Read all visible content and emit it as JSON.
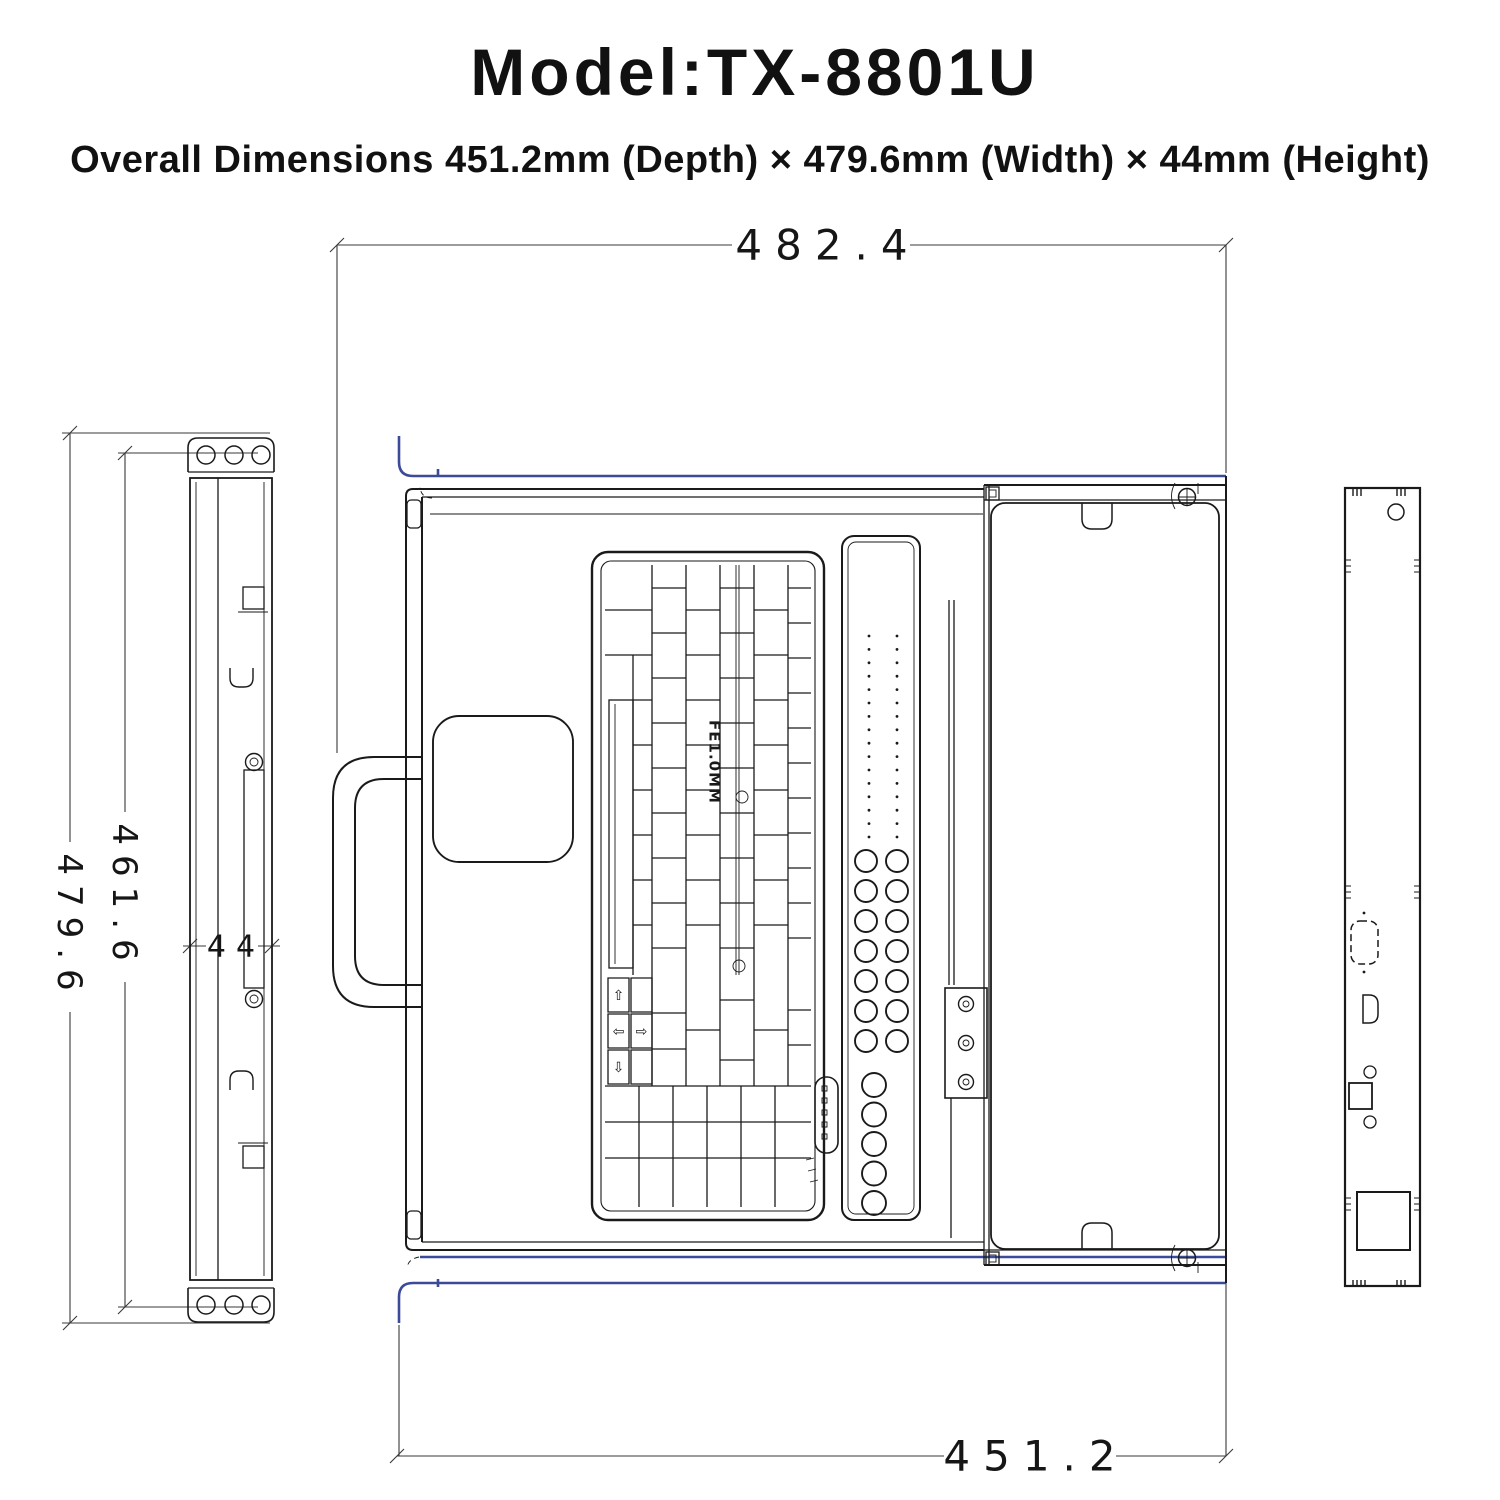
{
  "title": "Model:TX-8801U",
  "subtitle": "Overall Dimensions 451.2mm (Depth) × 479.6mm (Width) × 44mm (Height)",
  "dims": {
    "width_with_ears": "482.4",
    "depth": "451.2",
    "height_outer": "479.6",
    "height_inner": "461.6",
    "thickness": "44"
  },
  "keyboard": {
    "marking": "FE1.0MM",
    "arrows": {
      "up": "⇧",
      "left": "⇦",
      "right": "⇨",
      "down": "⇩"
    }
  },
  "colors": {
    "line": "#1a1a1a",
    "dimension_line": "#3a3a3a",
    "rail_blue": "#3b4a99",
    "background": "#ffffff"
  }
}
